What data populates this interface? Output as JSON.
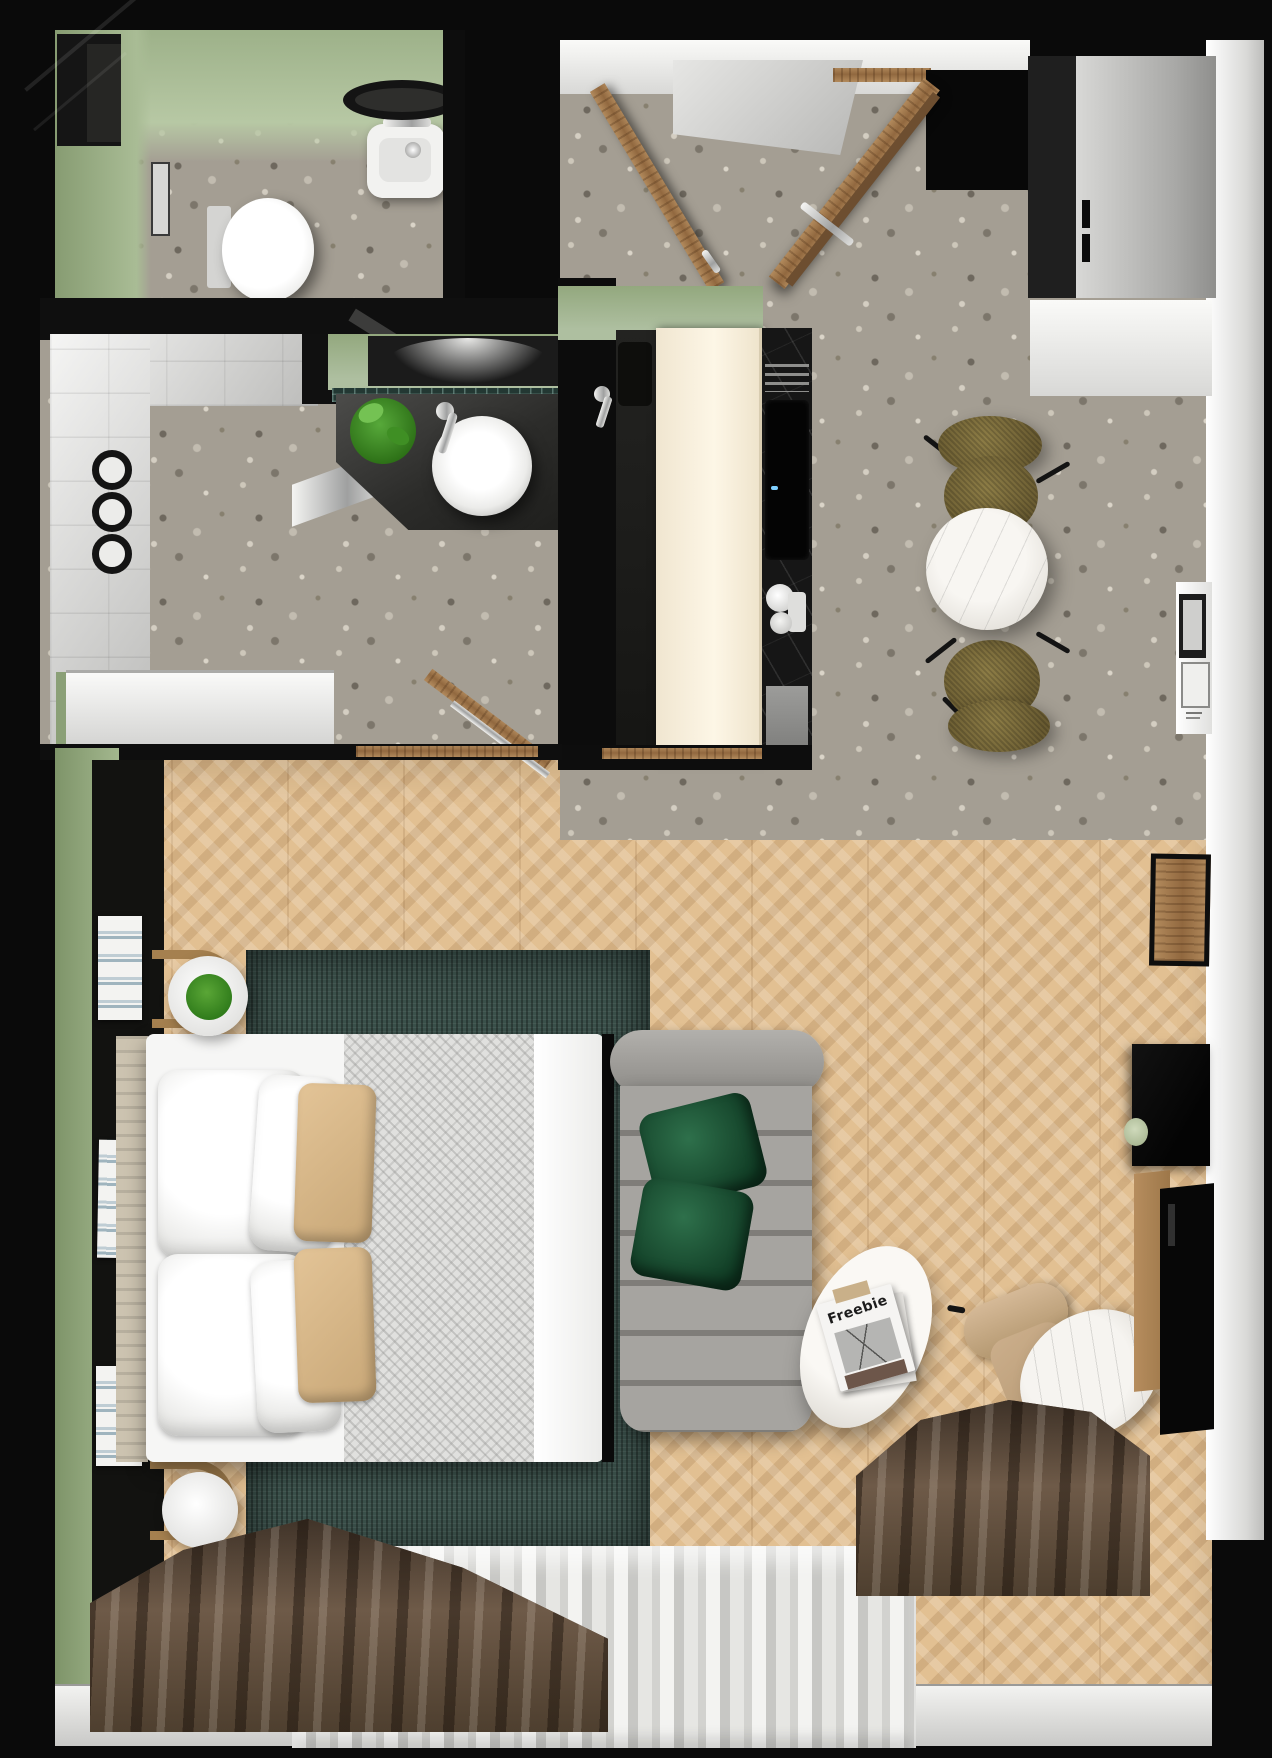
{
  "scene": {
    "title": "Top-down 3D floor plan of a studio apartment",
    "render_type": "3d-floor-plan",
    "width_px": 1272,
    "height_px": 1758
  },
  "palette": {
    "wall_green": "#9db189",
    "wall_white": "#f2f2f0",
    "floor_terrazzo": "#a49e93",
    "floor_wood_chevron": "#e2c092",
    "rug_teal": "#3b514b",
    "sofa_gray": "#9c9a96",
    "pillow_green": "#1f5c3d",
    "pillow_tan": "#d9b98c",
    "curtain_brown": "#5d4c3d",
    "curtain_sheer": "#e6e6e3",
    "counter_black": "#161616",
    "cabinet_cream": "#f3e9d3",
    "chair_olive": "#7b6f3e",
    "door_wood": "#a87e52"
  },
  "rooms": [
    {
      "name": "WC",
      "furniture": [
        "wall-hung toilet",
        "hand basin",
        "round mirror",
        "tall cabinet",
        "wall frame"
      ]
    },
    {
      "name": "Entry hall",
      "furniture": [
        "entry door (open)",
        "bathroom door (open)",
        "wood door frame",
        "terrazzo floor"
      ]
    },
    {
      "name": "Wardrobe nook",
      "furniture": [
        "white wardrobe cabinet"
      ]
    },
    {
      "name": "Shower room",
      "furniture": [
        "walk-in shower",
        "rain shower head",
        "towel hooks",
        "glass screen",
        "towel ladder"
      ]
    },
    {
      "name": "Vanity",
      "furniture": [
        "stone counter",
        "vessel sink",
        "faucet",
        "potted plant",
        "mirror",
        "mosaic splashback"
      ]
    },
    {
      "name": "Kitchen",
      "furniture": [
        "tall cream cabinet",
        "black stone counter",
        "sink and faucet",
        "induction hob",
        "drying rack",
        "espresso machine",
        "serving tray"
      ]
    },
    {
      "name": "Dining nook",
      "furniture": [
        "round marble table",
        "two olive chairs",
        "wall art ledge"
      ]
    },
    {
      "name": "Bedroom / living",
      "furniture": [
        "double bed",
        "white pillows",
        "tan cushions",
        "gray throw",
        "teal rug",
        "headboard console with books",
        "bentwood wall handles",
        "round side table with plant",
        "round side table",
        "gray channel-tufted sofa",
        "green cushions",
        "oval coffee table",
        "magazine",
        "tan armchair",
        "oval marble side table",
        "black desk with cup",
        "wood wall frame",
        "sideboard"
      ]
    },
    {
      "name": "Window bay",
      "furniture": [
        "brown blackout curtains",
        "white sheer curtain",
        "window sill"
      ]
    }
  ],
  "living": {
    "magazine_title": "Freebie"
  }
}
